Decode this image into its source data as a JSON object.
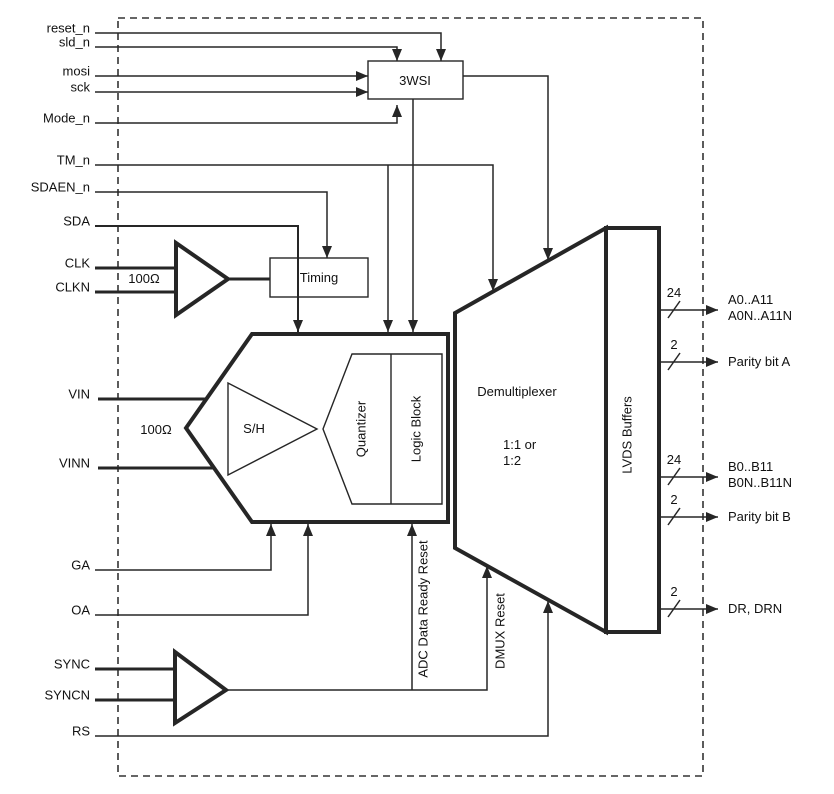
{
  "diagram": {
    "canvas": {
      "width": 834,
      "height": 794,
      "background": "#ffffff",
      "ink": "#262626",
      "fill": "#ffffff"
    },
    "chip_boundary": {
      "x": 118,
      "y": 18,
      "w": 585,
      "h": 758,
      "dash": "7 5",
      "stroke": 1.6
    },
    "shapes": [
      {
        "name": "block-adc-core",
        "type": "polygon",
        "points": "252,334 448,334 448,522 252,522 186,428",
        "stroke": 4
      },
      {
        "name": "block-demultiplexer",
        "type": "polygon",
        "points": "606,228 455,313 455,548 606,632",
        "stroke": 4
      },
      {
        "name": "block-lvds-buffers",
        "type": "rect",
        "x": 606,
        "y": 228,
        "w": 53,
        "h": 404,
        "stroke": 4
      },
      {
        "name": "block-quantizer-logic",
        "type": "polygon",
        "points": "352,354 442,354 442,504 352,504 323,429",
        "stroke": 1.4
      },
      {
        "name": "shape-sh-amp-triangle",
        "type": "polygon",
        "points": "228,383 228,475 317,429",
        "stroke": 1.4
      },
      {
        "name": "shape-clk-buffer-triangle",
        "type": "polygon",
        "points": "176,243 176,315 228,279",
        "stroke": 4
      },
      {
        "name": "shape-sync-buffer-triangle",
        "type": "polygon",
        "points": "175,652 175,723 226,690",
        "stroke": 4
      },
      {
        "name": "block-timing",
        "type": "rect",
        "x": 270,
        "y": 258,
        "w": 98,
        "h": 39,
        "stroke": 1.4
      },
      {
        "name": "block-3wsi",
        "type": "rect",
        "x": 368,
        "y": 61,
        "w": 95,
        "h": 38,
        "stroke": 1.4
      }
    ],
    "wires": [
      {
        "name": "divider-quantizer-logic",
        "pts": [
          [
            391,
            354
          ],
          [
            391,
            504
          ]
        ],
        "w": 1.4
      },
      {
        "name": "wire-reset_n",
        "pts": [
          [
            95,
            33
          ],
          [
            441,
            33
          ],
          [
            441,
            61
          ]
        ],
        "w": 1.5,
        "arrow": true
      },
      {
        "name": "wire-sld_n",
        "pts": [
          [
            95,
            47
          ],
          [
            397,
            47
          ],
          [
            397,
            61
          ]
        ],
        "w": 1.5,
        "arrow": true
      },
      {
        "name": "wire-mosi",
        "pts": [
          [
            95,
            76
          ],
          [
            368,
            76
          ]
        ],
        "w": 1.5,
        "arrow": true
      },
      {
        "name": "wire-sck",
        "pts": [
          [
            95,
            92
          ],
          [
            368,
            92
          ]
        ],
        "w": 1.5,
        "arrow": true
      },
      {
        "name": "wire-mode_n",
        "pts": [
          [
            95,
            123
          ],
          [
            397,
            123
          ],
          [
            397,
            105
          ]
        ],
        "w": 1.5,
        "arrow": true
      },
      {
        "name": "wire-tm_n",
        "pts": [
          [
            95,
            165
          ],
          [
            493,
            165
          ],
          [
            493,
            291
          ]
        ],
        "w": 1.5,
        "arrow": true
      },
      {
        "name": "wire-tm_n-adc-branch",
        "pts": [
          [
            388,
            165
          ],
          [
            388,
            332
          ]
        ],
        "w": 1.5,
        "arrow": true
      },
      {
        "name": "wire-sdaen_n",
        "pts": [
          [
            95,
            192
          ],
          [
            327,
            192
          ],
          [
            327,
            258
          ]
        ],
        "w": 1.5,
        "arrow": true
      },
      {
        "name": "wire-sda",
        "pts": [
          [
            95,
            226
          ],
          [
            298,
            226
          ],
          [
            298,
            332
          ]
        ],
        "w": 2,
        "arrow": true
      },
      {
        "name": "wire-clk",
        "pts": [
          [
            95,
            268
          ],
          [
            176,
            268
          ]
        ],
        "w": 3
      },
      {
        "name": "wire-clkn",
        "pts": [
          [
            95,
            292
          ],
          [
            176,
            292
          ]
        ],
        "w": 3
      },
      {
        "name": "wire-clkbuf-to-timing",
        "pts": [
          [
            228,
            279
          ],
          [
            270,
            279
          ]
        ],
        "w": 3
      },
      {
        "name": "wire-3wsi-to-adc",
        "pts": [
          [
            413,
            99
          ],
          [
            413,
            332
          ]
        ],
        "w": 1.5,
        "arrow": true
      },
      {
        "name": "wire-3wsi-to-demux",
        "pts": [
          [
            463,
            76
          ],
          [
            548,
            76
          ],
          [
            548,
            260
          ]
        ],
        "w": 1.5,
        "arrow": true
      },
      {
        "name": "wire-vin",
        "pts": [
          [
            98,
            399
          ],
          [
            207,
            399
          ]
        ],
        "w": 3
      },
      {
        "name": "wire-vinn",
        "pts": [
          [
            98,
            468
          ],
          [
            215,
            468
          ]
        ],
        "w": 3
      },
      {
        "name": "wire-ga",
        "pts": [
          [
            95,
            570
          ],
          [
            271,
            570
          ],
          [
            271,
            524
          ]
        ],
        "w": 1.5,
        "arrow": true
      },
      {
        "name": "wire-oa",
        "pts": [
          [
            95,
            615
          ],
          [
            308,
            615
          ],
          [
            308,
            524
          ]
        ],
        "w": 1.5,
        "arrow": true
      },
      {
        "name": "wire-sync",
        "pts": [
          [
            95,
            669
          ],
          [
            175,
            669
          ]
        ],
        "w": 3
      },
      {
        "name": "wire-syncn",
        "pts": [
          [
            95,
            700
          ],
          [
            175,
            700
          ]
        ],
        "w": 3
      },
      {
        "name": "wire-syncbuf-to-dmux-reset",
        "pts": [
          [
            226,
            690
          ],
          [
            487,
            690
          ],
          [
            487,
            566
          ]
        ],
        "w": 1.5,
        "arrow": true
      },
      {
        "name": "wire-adc-data-ready-reset",
        "pts": [
          [
            412,
            690
          ],
          [
            412,
            524
          ]
        ],
        "w": 1.5,
        "arrow": true
      },
      {
        "name": "wire-rs",
        "pts": [
          [
            95,
            736
          ],
          [
            548,
            736
          ],
          [
            548,
            601
          ]
        ],
        "w": 1.5,
        "arrow": true
      }
    ],
    "pins": [
      {
        "name": "pin-reset_n",
        "text": "reset_n",
        "y": 33
      },
      {
        "name": "pin-sld_n",
        "text": "sld_n",
        "y": 47
      },
      {
        "name": "pin-mosi",
        "text": "mosi",
        "y": 76
      },
      {
        "name": "pin-sck",
        "text": "sck",
        "y": 92
      },
      {
        "name": "pin-mode_n",
        "text": "Mode_n",
        "y": 123
      },
      {
        "name": "pin-tm_n",
        "text": "TM_n",
        "y": 165
      },
      {
        "name": "pin-sdaen_n",
        "text": "SDAEN_n",
        "y": 192
      },
      {
        "name": "pin-sda",
        "text": "SDA",
        "y": 226
      },
      {
        "name": "pin-clk",
        "text": "CLK",
        "y": 268
      },
      {
        "name": "pin-clkn",
        "text": "CLKN",
        "y": 292
      },
      {
        "name": "pin-vin",
        "text": "VIN",
        "y": 399
      },
      {
        "name": "pin-vinn",
        "text": "VINN",
        "y": 468
      },
      {
        "name": "pin-ga",
        "text": "GA",
        "y": 570
      },
      {
        "name": "pin-oa",
        "text": "OA",
        "y": 615
      },
      {
        "name": "pin-sync",
        "text": "SYNC",
        "y": 669
      },
      {
        "name": "pin-syncn",
        "text": "SYNCN",
        "y": 700
      },
      {
        "name": "pin-rs",
        "text": "RS",
        "y": 736
      }
    ],
    "texts": [
      {
        "name": "label-3wsi",
        "text": "3WSI",
        "x": 415,
        "y": 85,
        "anchor": "middle"
      },
      {
        "name": "label-timing",
        "text": "Timing",
        "x": 319,
        "y": 282,
        "anchor": "middle"
      },
      {
        "name": "label-sh",
        "text": "S/H",
        "x": 254,
        "y": 433,
        "anchor": "middle"
      },
      {
        "name": "label-demultiplexer",
        "text": "Demultiplexer",
        "x": 517,
        "y": 396,
        "anchor": "middle"
      },
      {
        "name": "label-demux-ratio-line1",
        "text": "1:1 or",
        "x": 503,
        "y": 449,
        "anchor": "start"
      },
      {
        "name": "label-demux-ratio-line2",
        "text": "1:2",
        "x": 503,
        "y": 465,
        "anchor": "start"
      },
      {
        "name": "label-clk-termination",
        "text": "100Ω",
        "x": 144,
        "y": 283,
        "anchor": "middle"
      },
      {
        "name": "label-vin-termination",
        "text": "100Ω",
        "x": 156,
        "y": 434,
        "anchor": "middle"
      },
      {
        "name": "label-quantizer",
        "text": "Quantizer",
        "x": 362,
        "y": 429,
        "anchor": "middle",
        "rotate": true
      },
      {
        "name": "label-logic-block",
        "text": "Logic Block",
        "x": 417,
        "y": 429,
        "anchor": "middle",
        "rotate": true
      },
      {
        "name": "label-adc-data-ready-reset",
        "text": "ADC Data Ready Reset",
        "x": 424,
        "y": 609,
        "anchor": "middle",
        "rotate": true
      },
      {
        "name": "label-dmux-reset",
        "text": "DMUX Reset",
        "x": 501,
        "y": 631,
        "anchor": "middle",
        "rotate": true
      },
      {
        "name": "label-lvds-buffers",
        "text": "LVDS Buffers",
        "x": 628,
        "y": 435,
        "anchor": "middle",
        "rotate": true
      }
    ],
    "outputs": [
      {
        "name": "output-data-a",
        "bus": "24",
        "labels": [
          "A0..A11",
          "A0N..A11N"
        ],
        "y": 310
      },
      {
        "name": "output-parity-a",
        "bus": "2",
        "labels": [
          "Parity bit A"
        ],
        "y": 362
      },
      {
        "name": "output-data-b",
        "bus": "24",
        "labels": [
          "B0..B11",
          "B0N..B11N"
        ],
        "y": 477
      },
      {
        "name": "output-parity-b",
        "bus": "2",
        "labels": [
          "Parity bit B"
        ],
        "y": 517
      },
      {
        "name": "output-dr",
        "bus": "2",
        "labels": [
          "DR, DRN"
        ],
        "y": 609
      }
    ],
    "output_geometry": {
      "line_x1": 659,
      "arrow_tip_x": 718,
      "label_x": 728,
      "slash_x": 668,
      "bus_x": 674
    }
  }
}
